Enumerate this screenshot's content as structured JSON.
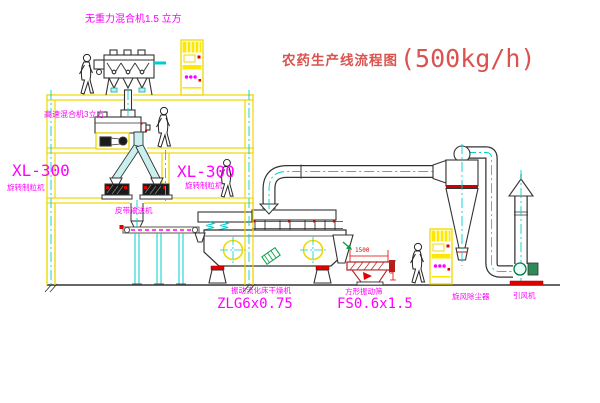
{
  "title": {
    "name": "农药生产线流程图",
    "capacity": "(500kg/h)"
  },
  "labels": {
    "gravity_mixer": "无重力混合机1.5 立方",
    "high_speed_mixer": "高速混合机3立方",
    "granulator_left_model": "XL-300",
    "granulator_left_name": "旋转制粒机",
    "granulator_right_model": "XL-300",
    "granulator_right_name": "旋转制粒机",
    "belt_conveyor": "皮带输送机",
    "dryer_name": "振动流化床干燥机",
    "dryer_model": "ZLG6x0.75",
    "sieve_name": "方形振动筛",
    "sieve_model": "FS0.6x1.5",
    "cyclone": "旋风除尘器",
    "fan": "引风机"
  },
  "dimensions": {
    "sieve_length": "1500",
    "sieve_height": "340"
  },
  "colors": {
    "background": "#FFFFFF",
    "structure_yellow": "#EED800",
    "centerline_cyan": "#00CFCF",
    "equipment_outline": "#2A2A2A",
    "label_magenta": "#FF00FF",
    "title_red": "#D9534F",
    "accent_red": "#E00000",
    "accent_green": "#00A040"
  }
}
